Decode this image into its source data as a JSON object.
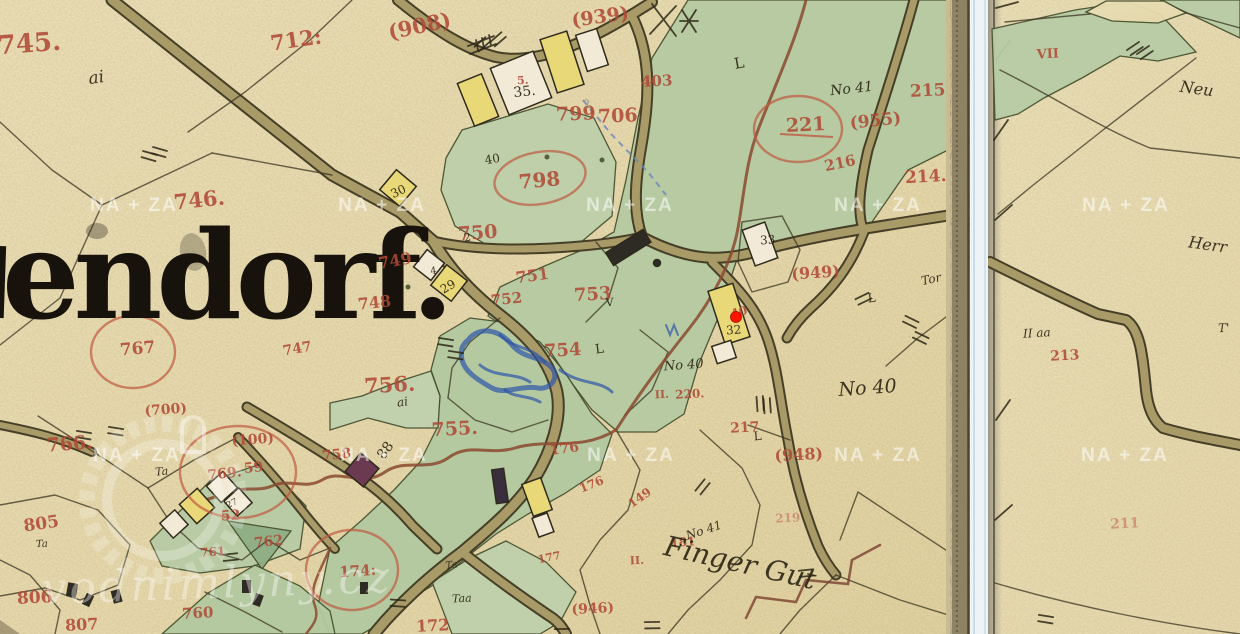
{
  "map": {
    "village_name": "endorf.",
    "marker": {
      "x": 736,
      "y": 317,
      "color": "#ff1500"
    },
    "watermarks": {
      "tile_text": "NA + ZA",
      "logo_text": "vodnimlyny.cz",
      "tile_positions": [
        [
          134,
          211
        ],
        [
          382,
          211
        ],
        [
          630,
          211
        ],
        [
          878,
          211
        ],
        [
          1126,
          211
        ],
        [
          137,
          461
        ],
        [
          384,
          461
        ],
        [
          631,
          461
        ],
        [
          878,
          461
        ],
        [
          1125,
          461
        ]
      ]
    },
    "labels": [
      {
        "t": "745.",
        "x": 30,
        "y": 52,
        "s": 26,
        "r": -4,
        "c": "red"
      },
      {
        "t": "712:",
        "x": 297,
        "y": 47,
        "s": 21,
        "r": -8,
        "c": "red"
      },
      {
        "t": "746.",
        "x": 200,
        "y": 207,
        "s": 21,
        "r": -6,
        "c": "red"
      },
      {
        "t": "(908)",
        "x": 421,
        "y": 33,
        "s": 21,
        "r": -12,
        "c": "red"
      },
      {
        "t": "(939)",
        "x": 601,
        "y": 23,
        "s": 19,
        "r": -8,
        "c": "red"
      },
      {
        "t": "403",
        "x": 657,
        "y": 86,
        "s": 15,
        "r": -3,
        "c": "red"
      },
      {
        "t": "799",
        "x": 576,
        "y": 120,
        "s": 19,
        "r": -2,
        "c": "red"
      },
      {
        "t": "706",
        "x": 618,
        "y": 122,
        "s": 19,
        "r": -2,
        "c": "red"
      },
      {
        "t": "798",
        "x": 540,
        "y": 187,
        "s": 20,
        "r": -5,
        "c": "red"
      },
      {
        "t": "215",
        "x": 928,
        "y": 96,
        "s": 17,
        "r": -3,
        "c": "red"
      },
      {
        "t": "221",
        "x": 806,
        "y": 131,
        "s": 19,
        "r": -3,
        "c": "red"
      },
      {
        "t": "(955)",
        "x": 876,
        "y": 126,
        "s": 17,
        "r": -6,
        "c": "red"
      },
      {
        "t": "216",
        "x": 841,
        "y": 168,
        "s": 15,
        "r": -12,
        "c": "red"
      },
      {
        "t": "214.",
        "x": 926,
        "y": 182,
        "s": 17,
        "r": -3,
        "c": "red"
      },
      {
        "t": "750",
        "x": 478,
        "y": 239,
        "s": 19,
        "r": -4,
        "c": "red"
      },
      {
        "t": "749",
        "x": 396,
        "y": 266,
        "s": 16,
        "r": -10,
        "c": "red"
      },
      {
        "t": "748",
        "x": 375,
        "y": 308,
        "s": 16,
        "r": -6,
        "c": "red"
      },
      {
        "t": "751",
        "x": 533,
        "y": 281,
        "s": 16,
        "r": -8,
        "c": "red"
      },
      {
        "t": "752",
        "x": 507,
        "y": 304,
        "s": 15,
        "r": -6,
        "c": "red"
      },
      {
        "t": "753",
        "x": 593,
        "y": 300,
        "s": 18,
        "r": -3,
        "c": "red"
      },
      {
        "t": "754",
        "x": 563,
        "y": 356,
        "s": 18,
        "r": -3,
        "c": "red"
      },
      {
        "t": "755.",
        "x": 455,
        "y": 435,
        "s": 19,
        "r": -3,
        "c": "red"
      },
      {
        "t": "756.",
        "x": 390,
        "y": 392,
        "s": 21,
        "r": -3,
        "c": "red"
      },
      {
        "t": "767",
        "x": 138,
        "y": 354,
        "s": 17,
        "r": -5,
        "c": "red"
      },
      {
        "t": "747",
        "x": 298,
        "y": 353,
        "s": 14,
        "r": -10,
        "c": "red"
      },
      {
        "t": "(700)",
        "x": 166,
        "y": 414,
        "s": 14,
        "r": -4,
        "c": "red"
      },
      {
        "t": "766.",
        "x": 70,
        "y": 450,
        "s": 19,
        "r": -4,
        "c": "red"
      },
      {
        "t": "(100)",
        "x": 253,
        "y": 444,
        "s": 14,
        "r": -4,
        "c": "red"
      },
      {
        "t": "769.",
        "x": 225,
        "y": 478,
        "s": 14,
        "r": -6,
        "c": "red"
      },
      {
        "t": "59",
        "x": 254,
        "y": 472,
        "s": 14,
        "r": -6,
        "c": "red"
      },
      {
        "t": "52",
        "x": 231,
        "y": 520,
        "s": 14,
        "r": -4,
        "c": "red"
      },
      {
        "t": "762",
        "x": 269,
        "y": 546,
        "s": 14,
        "r": -6,
        "c": "red"
      },
      {
        "t": "761",
        "x": 213,
        "y": 556,
        "s": 12,
        "r": -4,
        "c": "red"
      },
      {
        "t": "758",
        "x": 337,
        "y": 459,
        "s": 14,
        "r": -6,
        "c": "red"
      },
      {
        "t": "805",
        "x": 42,
        "y": 529,
        "s": 17,
        "r": -8,
        "c": "red"
      },
      {
        "t": "806",
        "x": 35,
        "y": 603,
        "s": 17,
        "r": -3,
        "c": "red"
      },
      {
        "t": "807",
        "x": 82,
        "y": 630,
        "s": 16,
        "r": -3,
        "c": "red"
      },
      {
        "t": "760",
        "x": 198,
        "y": 618,
        "s": 15,
        "r": -3,
        "c": "red"
      },
      {
        "t": "174:",
        "x": 358,
        "y": 576,
        "s": 15,
        "r": -4,
        "c": "red"
      },
      {
        "t": "172",
        "x": 433,
        "y": 631,
        "s": 16,
        "r": -3,
        "c": "red"
      },
      {
        "t": "176",
        "x": 565,
        "y": 453,
        "s": 14,
        "r": -8,
        "c": "red"
      },
      {
        "t": "176",
        "x": 593,
        "y": 488,
        "s": 12,
        "r": -22,
        "c": "red"
      },
      {
        "t": "149",
        "x": 642,
        "y": 501,
        "s": 12,
        "r": -35,
        "c": "red"
      },
      {
        "t": "177",
        "x": 550,
        "y": 561,
        "s": 11,
        "r": -12,
        "c": "red"
      },
      {
        "t": "(946)",
        "x": 593,
        "y": 613,
        "s": 14,
        "r": -3,
        "c": "red"
      },
      {
        "t": "217",
        "x": 745,
        "y": 432,
        "s": 14,
        "r": -3,
        "c": "red"
      },
      {
        "t": "(948)",
        "x": 799,
        "y": 460,
        "s": 16,
        "r": -3,
        "c": "red"
      },
      {
        "t": "219",
        "x": 788,
        "y": 522,
        "s": 12,
        "r": -3,
        "c": "redf"
      },
      {
        "t": "181",
        "x": 683,
        "y": 546,
        "s": 12,
        "r": -3,
        "c": "red"
      },
      {
        "t": "II.",
        "x": 662,
        "y": 398,
        "s": 11,
        "r": -3,
        "c": "red"
      },
      {
        "t": "220.",
        "x": 690,
        "y": 398,
        "s": 12,
        "r": -3,
        "c": "red"
      },
      {
        "t": "(949)",
        "x": 816,
        "y": 278,
        "s": 16,
        "r": -4,
        "c": "red"
      },
      {
        "t": "40",
        "x": 740,
        "y": 316,
        "s": 12,
        "r": -15,
        "c": "red"
      },
      {
        "t": "5.",
        "x": 523,
        "y": 84,
        "s": 11,
        "r": -3,
        "c": "red"
      },
      {
        "t": "II.",
        "x": 637,
        "y": 564,
        "s": 11,
        "r": -3,
        "c": "red"
      },
      {
        "t": "VII",
        "x": 1048,
        "y": 58,
        "s": 13,
        "r": -3,
        "c": "red"
      },
      {
        "t": "213",
        "x": 1065,
        "y": 360,
        "s": 14,
        "r": -3,
        "c": "red"
      },
      {
        "t": "211",
        "x": 1125,
        "y": 528,
        "s": 14,
        "r": -3,
        "c": "redf"
      },
      {
        "t": "35.",
        "x": 525,
        "y": 96,
        "s": 14,
        "r": -6,
        "c": "ink"
      },
      {
        "t": "40",
        "x": 493,
        "y": 163,
        "s": 12,
        "r": -10,
        "c": "ink"
      },
      {
        "t": "30",
        "x": 400,
        "y": 195,
        "s": 12,
        "r": -25,
        "c": "ink"
      },
      {
        "t": "29",
        "x": 450,
        "y": 290,
        "s": 12,
        "r": -30,
        "c": "ink"
      },
      {
        "t": "4",
        "x": 434,
        "y": 274,
        "s": 10,
        "r": -10,
        "c": "ink"
      },
      {
        "t": "33",
        "x": 768,
        "y": 244,
        "s": 12,
        "r": -4,
        "c": "ink"
      },
      {
        "t": "32",
        "x": 734,
        "y": 334,
        "s": 12,
        "r": -4,
        "c": "ink"
      },
      {
        "t": "27",
        "x": 233,
        "y": 506,
        "s": 9,
        "r": -25,
        "c": "ink"
      },
      {
        "t": "88",
        "x": 389,
        "y": 453,
        "s": 14,
        "r": -55,
        "c": "ink"
      },
      {
        "t": "2",
        "x": 468,
        "y": 241,
        "s": 11,
        "r": -10,
        "c": "ink"
      },
      {
        "t": "L",
        "x": 740,
        "y": 68,
        "s": 15,
        "r": -10,
        "c": "ink"
      },
      {
        "t": "L",
        "x": 600,
        "y": 353,
        "s": 13,
        "r": -8,
        "c": "ink"
      },
      {
        "t": "V",
        "x": 610,
        "y": 306,
        "s": 11,
        "r": -5,
        "c": "ink"
      },
      {
        "t": "L",
        "x": 758,
        "y": 440,
        "s": 12,
        "r": -5,
        "c": "ink"
      },
      {
        "t": "L",
        "x": 872,
        "y": 302,
        "s": 12,
        "r": -5,
        "c": "ink"
      },
      {
        "t": "2",
        "x": 588,
        "y": 108,
        "s": 12,
        "r": -15,
        "c": "pencil"
      },
      {
        "t": "ai",
        "x": 97,
        "y": 83,
        "s": 17,
        "r": -8,
        "c": "ink",
        "i": 1
      },
      {
        "t": "ai",
        "x": 403,
        "y": 406,
        "s": 12,
        "r": -8,
        "c": "ink",
        "i": 1
      },
      {
        "t": "No 41",
        "x": 852,
        "y": 93,
        "s": 14,
        "r": -6,
        "c": "ink",
        "i": 1
      },
      {
        "t": "No 40",
        "x": 684,
        "y": 369,
        "s": 13,
        "r": -4,
        "c": "ink",
        "i": 1
      },
      {
        "t": "No 40",
        "x": 868,
        "y": 394,
        "s": 19,
        "r": -4,
        "c": "ink",
        "i": 1
      },
      {
        "t": "No 41",
        "x": 705,
        "y": 534,
        "s": 12,
        "r": -18,
        "c": "ink",
        "i": 1
      },
      {
        "t": "Tor",
        "x": 932,
        "y": 283,
        "s": 12,
        "r": -12,
        "c": "ink",
        "i": 1
      },
      {
        "t": "Ta",
        "x": 162,
        "y": 475,
        "s": 11,
        "r": -5,
        "c": "ink",
        "i": 1
      },
      {
        "t": "Ta",
        "x": 42,
        "y": 547,
        "s": 10,
        "r": -3,
        "c": "ink",
        "i": 1
      },
      {
        "t": "Taa",
        "x": 462,
        "y": 602,
        "s": 11,
        "r": -3,
        "c": "ink",
        "i": 1
      },
      {
        "t": "Ta",
        "x": 452,
        "y": 568,
        "s": 10,
        "r": -8,
        "c": "ink",
        "i": 1
      },
      {
        "t": "Finger Gut",
        "x": 738,
        "y": 572,
        "s": 28,
        "r": 13,
        "c": "ink",
        "i": 1
      },
      {
        "t": "Neu",
        "x": 1196,
        "y": 94,
        "s": 16,
        "r": 8,
        "c": "ink",
        "i": 1
      },
      {
        "t": "Herr",
        "x": 1207,
        "y": 250,
        "s": 16,
        "r": 8,
        "c": "ink",
        "i": 1
      },
      {
        "t": "T'",
        "x": 1224,
        "y": 332,
        "s": 12,
        "r": -3,
        "c": "ink",
        "i": 1
      },
      {
        "t": "II aa",
        "x": 1037,
        "y": 337,
        "s": 12,
        "r": -3,
        "c": "ink",
        "i": 1
      }
    ]
  }
}
